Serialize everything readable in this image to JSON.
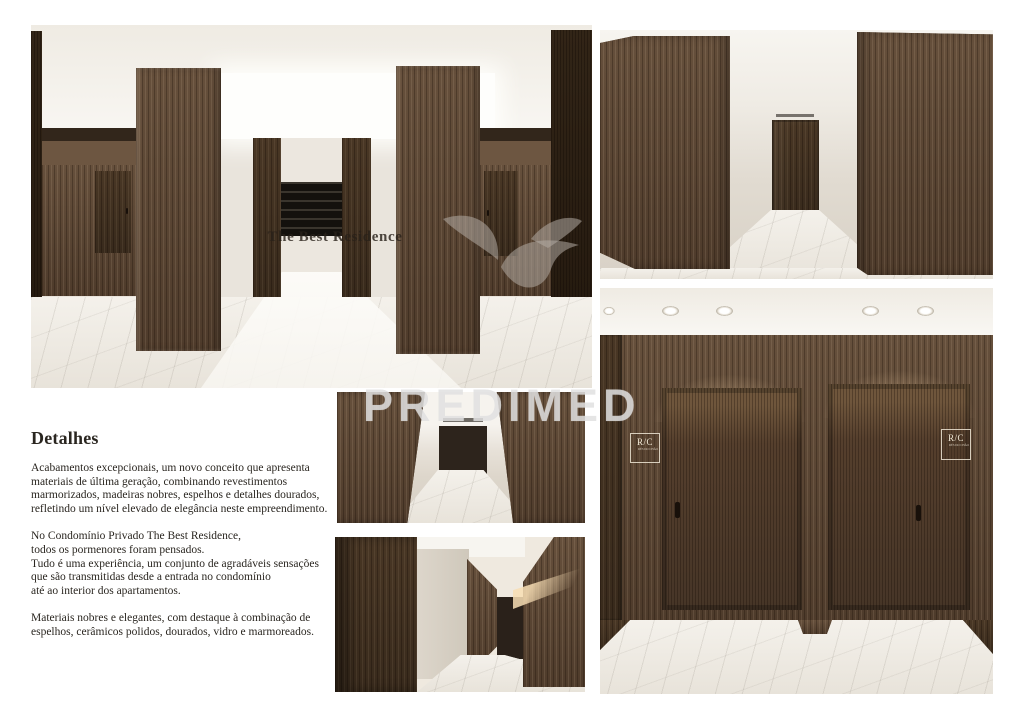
{
  "document": {
    "kind": "property-brochure-page",
    "background": "#ffffff"
  },
  "watermark": {
    "brand": "PREDIMED",
    "color": "#dedede"
  },
  "lobby_overlay": {
    "residence_name": "The Best Residence"
  },
  "elevator_signs": {
    "left": {
      "label": "R/C",
      "subtext": "RÉS DO CHÃO"
    },
    "right": {
      "label": "R/C",
      "subtext": "RÉS DO CHÃO"
    }
  },
  "text_block": {
    "heading": "Detalhes",
    "paragraph_1": "Acabamentos excepcionais, um novo conceito que apresenta\nmateriais de última geração, combinando revestimentos\nmarmorizados, madeiras nobres, espelhos e detalhes dourados,\nrefletindo um nível elevado de elegância neste empreendimento.",
    "paragraph_2": "No Condomínio Privado The Best Residence,\ntodos os pormenores foram pensados.\nTudo é uma experiência, um conjunto de agradáveis sensações\nque são transmitidas desde a entrada no condomínio\naté ao interior dos apartamentos.",
    "paragraph_3": "Materiais nobres e elegantes, com destaque à combinação de\nespelhos, cerâmicos polidos, dourados, vidro e marmoreados."
  },
  "palette": {
    "wood_mid": "#5d4836",
    "wood_dark": "#44331f",
    "marble": "#efebe3",
    "ceiling": "#f6f3ee",
    "text": "#2a2620"
  }
}
